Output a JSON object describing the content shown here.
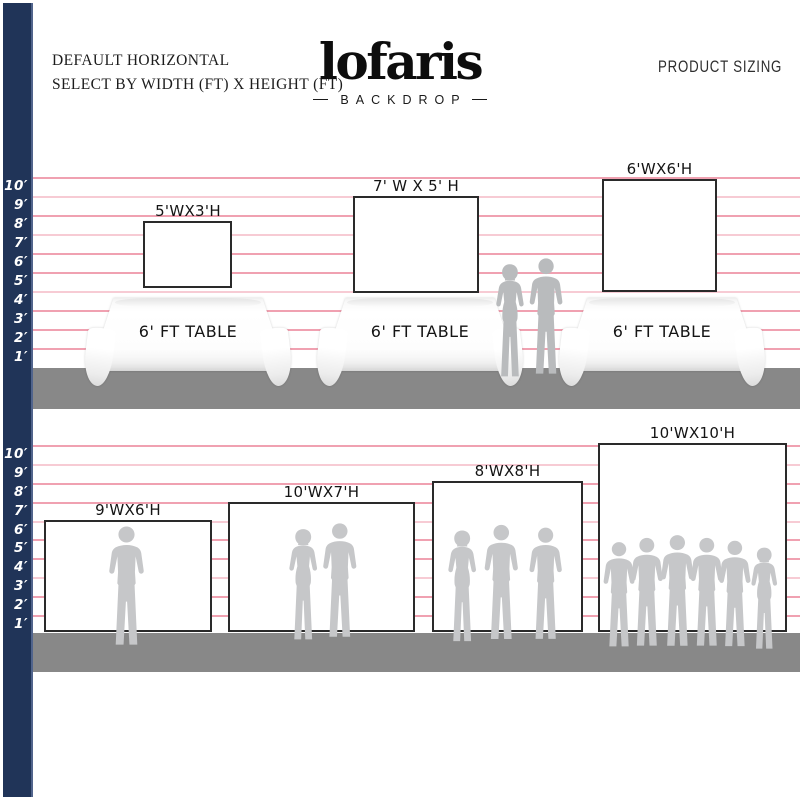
{
  "header": {
    "left_title_line1": "DEFAULT HORIZONTAL",
    "left_title_line2": "SELECT BY WIDTH (FT) X HEIGHT (FT)",
    "logo_text": "lofaris",
    "logo_subtext": "BACKDROP",
    "right_title": "PRODUCT SIZING"
  },
  "ruler": {
    "unit": "ft",
    "labels": [
      "10′",
      "9′",
      "8′",
      "7′",
      "6′",
      "5′",
      "4′",
      "3′",
      "2′",
      "1′"
    ]
  },
  "top_section": {
    "table_label": "6' FT TABLE",
    "backdrops": [
      {
        "label": "5'WX3'H",
        "width_ft": 5,
        "height_ft": 3
      },
      {
        "label": "7' W X 5' H",
        "width_ft": 7,
        "height_ft": 5
      },
      {
        "label": "6'WX6'H",
        "width_ft": 6,
        "height_ft": 6
      }
    ]
  },
  "bottom_section": {
    "backdrops": [
      {
        "label": "9'WX6'H",
        "width_ft": 9,
        "height_ft": 6
      },
      {
        "label": "10'WX7'H",
        "width_ft": 10,
        "height_ft": 7
      },
      {
        "label": "8'WX8'H",
        "width_ft": 8,
        "height_ft": 8
      },
      {
        "label": "10'WX10'H",
        "width_ft": 10,
        "height_ft": 10
      }
    ]
  },
  "colors": {
    "sidebar_navy": "#203458",
    "grid_line_pink": "#f0a1b1",
    "floor_gray": "#888888",
    "silhouette_gray": "#c6c7c9",
    "backdrop_border": "#2a2a2a"
  }
}
